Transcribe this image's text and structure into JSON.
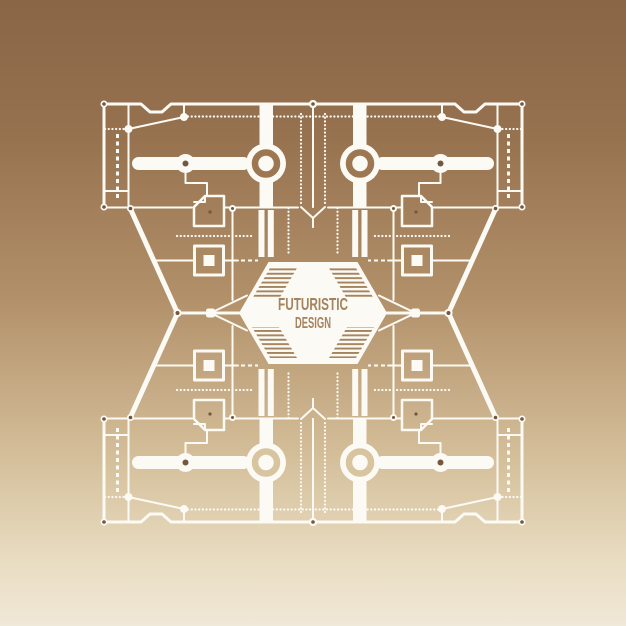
{
  "poster": {
    "title_line1": "FUTURISTIC",
    "title_line2": "DESIGN"
  },
  "colors": {
    "background_top": "#8a6546",
    "background_mid": "#b2916a",
    "background_bottom": "#f0e8d8",
    "line": "#fcfaf4",
    "accent": "#a5835d",
    "dark_dot": "#75573c",
    "donut_ring_top": "#9d7751",
    "donut_ring_bottom": "#d8c5a0"
  }
}
